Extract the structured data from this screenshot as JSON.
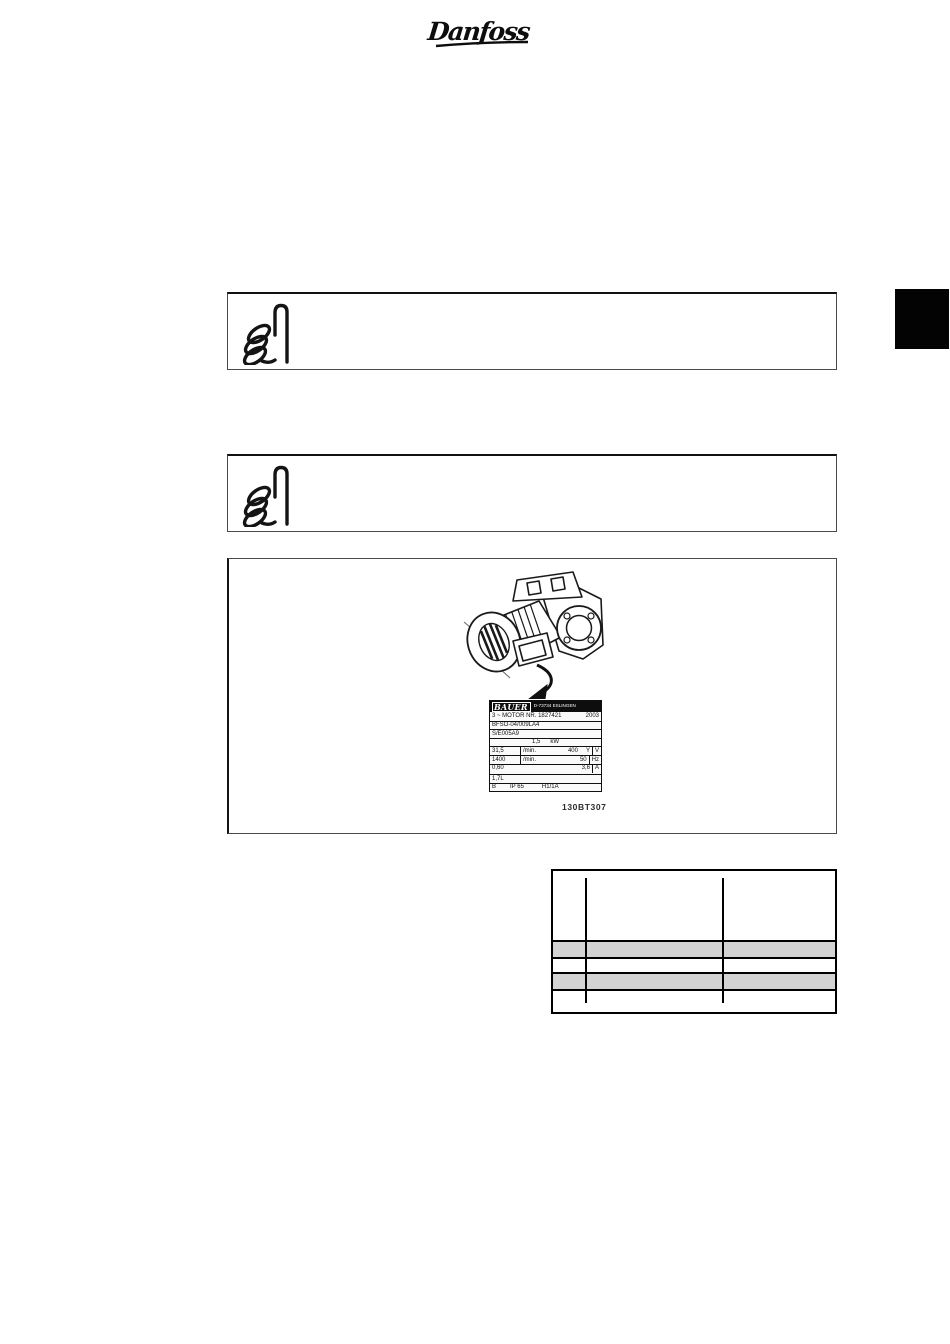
{
  "page": {
    "brand_logo": "Danfoss"
  },
  "note_boxes": [
    {
      "icon": "pointing-hand-icon",
      "text": ""
    },
    {
      "icon": "pointing-hand-icon",
      "text": ""
    }
  ],
  "figure": {
    "caption": "130BT307",
    "illustration": "gear-motor-with-nameplate",
    "nameplate": {
      "brand": "BAUER",
      "address": "D-73734 ESLINGEN",
      "motor_line": "3 ~ MOTOR NR. 1827421",
      "year": "2003",
      "type_code": "BFSO-04/009LA4",
      "serial_code": "S/E005A9",
      "power_value": "1,5",
      "power_unit": "kW",
      "output_speed": "31,5",
      "output_speed_unit": "/min.",
      "voltage": "400",
      "connection": "Y",
      "voltage_unit": "V",
      "motor_speed": "1400",
      "motor_speed_unit": "/min.",
      "frequency": "50",
      "frequency_unit": "Hz",
      "cos_phi": "0,60",
      "current": "3,6",
      "current_unit": "A",
      "oil_volume": "1,7L",
      "insulation_class": "B",
      "protection": "IP 65",
      "code": "H1/1A"
    }
  },
  "spec_table": {
    "columns": 3,
    "highlight_row_count": 2,
    "cells_text": ""
  },
  "colors": {
    "row_highlight": "#d3d3d3",
    "tab_fill": "#030303",
    "ink": "#111111"
  }
}
